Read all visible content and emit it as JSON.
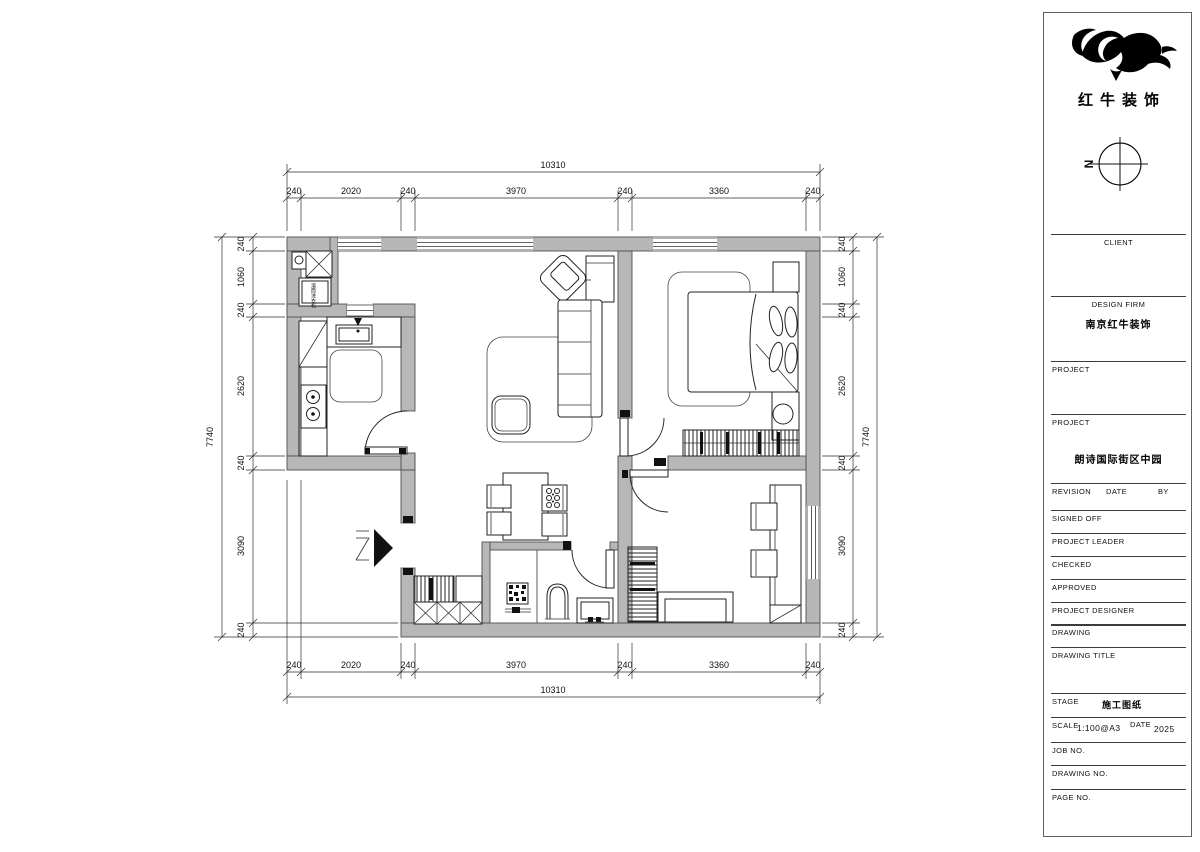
{
  "title_block": {
    "brand_name": "红牛装饰",
    "north_label": "N",
    "client_label": "CLIENT",
    "design_firm_label": "DESIGN FIRM",
    "design_firm_value": "南京红牛装饰",
    "project_label_1": "PROJECT",
    "project_label_2": "PROJECT",
    "project_value": "朗诗国际街区中园",
    "revision_label": "REVISION",
    "date_label": "DATE",
    "by_label": "BY",
    "signed_off_label": "SIGNED OFF",
    "project_leader_label": "PROJECT LEADER",
    "checked_label": "CHECKED",
    "approved_label": "APPROVED",
    "project_designer_label": "PROJECT DESIGNER",
    "drawing_label": "DRAWING",
    "drawing_title_label": "DRAWING TITLE",
    "stage_label": "STAGE",
    "stage_value": "施工图纸",
    "scale_label": "SCALE",
    "scale_value": "1:100@A3",
    "date_field_label": "DATE",
    "date_value": "2025",
    "job_no_label": "JOB NO.",
    "drawing_no_label": "DRAWING NO.",
    "page_no_label": "PAGE NO."
  },
  "plan": {
    "washer_label": "滚筒洗衣机"
  },
  "colors": {
    "wall_fill": "#b7b7b7",
    "line": "#1a1a1a",
    "washer_label_color": "#b4541e"
  },
  "dimensions": {
    "top": {
      "overall": "10310",
      "segments": [
        "240",
        "2020",
        "240",
        "3970",
        "240",
        "3360",
        "240"
      ]
    },
    "bottom": {
      "overall": "10310",
      "segments": [
        "240",
        "2020",
        "240",
        "3970",
        "240",
        "3360",
        "240"
      ]
    },
    "left": {
      "overall": "7740",
      "segments": [
        "240",
        "1060",
        "240",
        "2620",
        "240",
        "3090",
        "240"
      ]
    },
    "right": {
      "overall": "7740",
      "segments": [
        "240",
        "1060",
        "240",
        "2620",
        "240",
        "3090",
        "240"
      ]
    }
  }
}
